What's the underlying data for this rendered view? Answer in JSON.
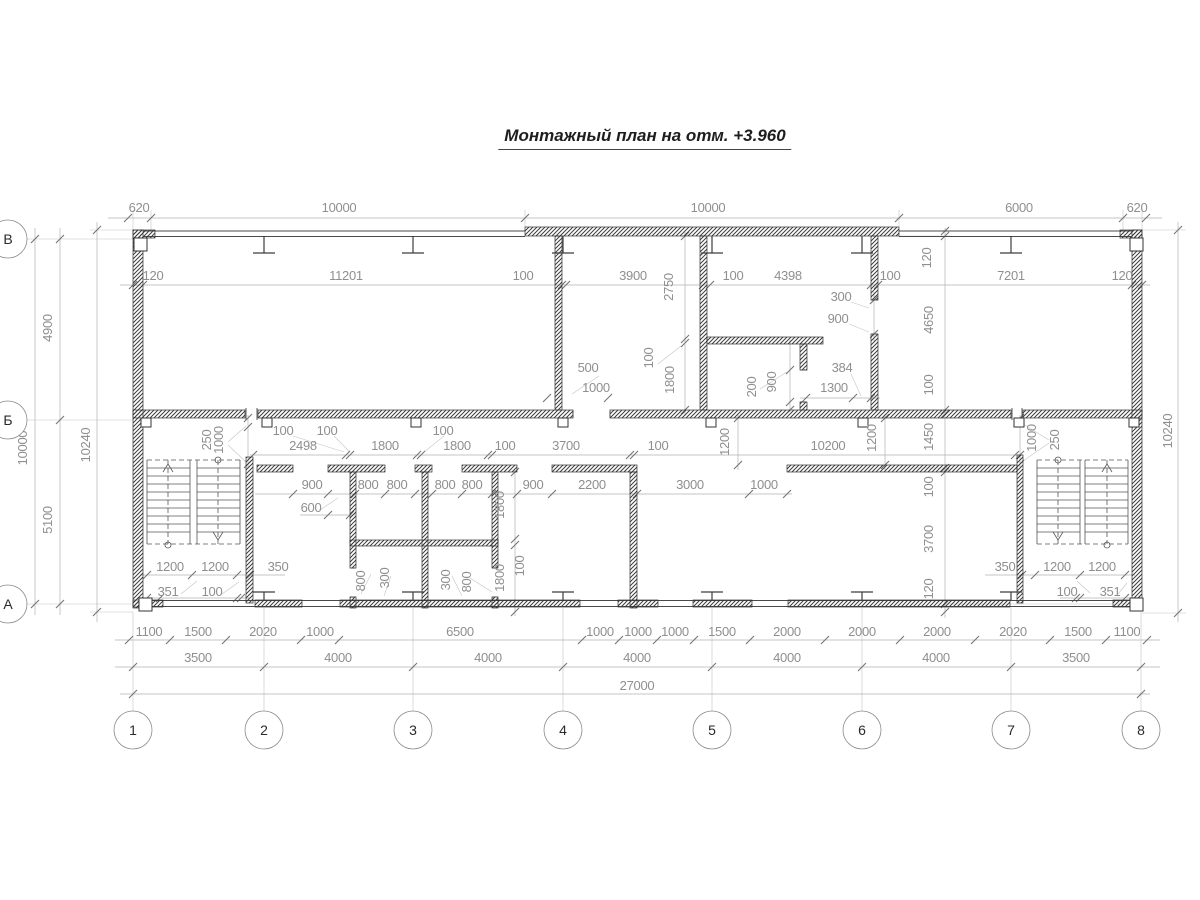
{
  "title": "Монтажный план на отм. +3.960",
  "colors": {
    "ink": "#3d3d3d",
    "dim_text": "#8f8f8f",
    "wall_hatch": "#3c3c3c",
    "background": "#ffffff"
  },
  "axes": {
    "bottom": [
      {
        "label": "1",
        "x": 133
      },
      {
        "label": "2",
        "x": 264
      },
      {
        "label": "3",
        "x": 413
      },
      {
        "label": "4",
        "x": 563
      },
      {
        "label": "5",
        "x": 712
      },
      {
        "label": "6",
        "x": 862
      },
      {
        "label": "7",
        "x": 1011
      },
      {
        "label": "8",
        "x": 1141
      }
    ],
    "left": [
      {
        "label": "В",
        "y": 239
      },
      {
        "label": "Б",
        "y": 420
      },
      {
        "label": "А",
        "y": 604
      }
    ]
  },
  "labels": [
    {
      "t": "620",
      "x": 139,
      "y": 212
    },
    {
      "t": "10000",
      "x": 339,
      "y": 212
    },
    {
      "t": "10000",
      "x": 708,
      "y": 212
    },
    {
      "t": "6000",
      "x": 1019,
      "y": 212
    },
    {
      "t": "620",
      "x": 1137,
      "y": 212
    },
    {
      "t": "120",
      "x": 153,
      "y": 280
    },
    {
      "t": "11201",
      "x": 346,
      "y": 280
    },
    {
      "t": "100",
      "x": 523,
      "y": 280
    },
    {
      "t": "3900",
      "x": 633,
      "y": 280
    },
    {
      "t": "100",
      "x": 733,
      "y": 280
    },
    {
      "t": "4398",
      "x": 788,
      "y": 280
    },
    {
      "t": "100",
      "x": 890,
      "y": 280
    },
    {
      "t": "7201",
      "x": 1011,
      "y": 280
    },
    {
      "t": "120",
      "x": 1122,
      "y": 280
    },
    {
      "t": "2750",
      "x": 673,
      "y": 287,
      "rot": true
    },
    {
      "t": "120",
      "x": 931,
      "y": 258,
      "rot": true
    },
    {
      "t": "4900",
      "x": 52,
      "y": 328,
      "rot": true
    },
    {
      "t": "10000",
      "x": 27,
      "y": 448,
      "rot": true
    },
    {
      "t": "10240",
      "x": 90,
      "y": 445,
      "rot": true
    },
    {
      "t": "5100",
      "x": 52,
      "y": 520,
      "rot": true
    },
    {
      "t": "10240",
      "x": 1172,
      "y": 431,
      "rot": true
    },
    {
      "t": "4650",
      "x": 933,
      "y": 320,
      "rot": true
    },
    {
      "t": "100",
      "x": 933,
      "y": 385,
      "rot": true
    },
    {
      "t": "1450",
      "x": 933,
      "y": 437,
      "rot": true
    },
    {
      "t": "100",
      "x": 933,
      "y": 487,
      "rot": true
    },
    {
      "t": "3700",
      "x": 933,
      "y": 539,
      "rot": true
    },
    {
      "t": "120",
      "x": 933,
      "y": 589,
      "rot": true
    },
    {
      "t": "300",
      "x": 841,
      "y": 301
    },
    {
      "t": "900",
      "x": 838,
      "y": 323
    },
    {
      "t": "500",
      "x": 588,
      "y": 372
    },
    {
      "t": "1000",
      "x": 596,
      "y": 392
    },
    {
      "t": "100",
      "x": 653,
      "y": 358,
      "rot": true
    },
    {
      "t": "1800",
      "x": 674,
      "y": 380,
      "rot": true
    },
    {
      "t": "200",
      "x": 756,
      "y": 387,
      "rot": true
    },
    {
      "t": "900",
      "x": 776,
      "y": 382,
      "rot": true
    },
    {
      "t": "384",
      "x": 842,
      "y": 372
    },
    {
      "t": "1300",
      "x": 834,
      "y": 392
    },
    {
      "t": "2498",
      "x": 303,
      "y": 450
    },
    {
      "t": "1800",
      "x": 385,
      "y": 450
    },
    {
      "t": "1800",
      "x": 457,
      "y": 450
    },
    {
      "t": "100",
      "x": 505,
      "y": 450
    },
    {
      "t": "3700",
      "x": 566,
      "y": 450
    },
    {
      "t": "100",
      "x": 658,
      "y": 450
    },
    {
      "t": "10200",
      "x": 828,
      "y": 450
    },
    {
      "t": "100",
      "x": 283,
      "y": 435
    },
    {
      "t": "100",
      "x": 327,
      "y": 435
    },
    {
      "t": "100",
      "x": 443,
      "y": 435
    },
    {
      "t": "1200",
      "x": 729,
      "y": 442,
      "rot": true
    },
    {
      "t": "1200",
      "x": 876,
      "y": 438,
      "rot": true
    },
    {
      "t": "250",
      "x": 211,
      "y": 440,
      "rot": true
    },
    {
      "t": "1000",
      "x": 223,
      "y": 440,
      "rot": true
    },
    {
      "t": "1000",
      "x": 1036,
      "y": 438,
      "rot": true
    },
    {
      "t": "250",
      "x": 1059,
      "y": 440,
      "rot": true
    },
    {
      "t": "900",
      "x": 312,
      "y": 489
    },
    {
      "t": "800",
      "x": 368,
      "y": 489
    },
    {
      "t": "800",
      "x": 397,
      "y": 489
    },
    {
      "t": "800",
      "x": 445,
      "y": 489
    },
    {
      "t": "800",
      "x": 472,
      "y": 489
    },
    {
      "t": "900",
      "x": 533,
      "y": 489
    },
    {
      "t": "2200",
      "x": 592,
      "y": 489
    },
    {
      "t": "3000",
      "x": 690,
      "y": 489
    },
    {
      "t": "1000",
      "x": 764,
      "y": 489
    },
    {
      "t": "600",
      "x": 311,
      "y": 512
    },
    {
      "t": "1800",
      "x": 504,
      "y": 505,
      "rot": true
    },
    {
      "t": "100",
      "x": 524,
      "y": 566,
      "rot": true
    },
    {
      "t": "1800",
      "x": 504,
      "y": 578,
      "rot": true
    },
    {
      "t": "800",
      "x": 365,
      "y": 581,
      "rot": true
    },
    {
      "t": "300",
      "x": 389,
      "y": 578,
      "rot": true
    },
    {
      "t": "300",
      "x": 450,
      "y": 580,
      "rot": true
    },
    {
      "t": "800",
      "x": 471,
      "y": 582,
      "rot": true
    },
    {
      "t": "1200",
      "x": 170,
      "y": 571
    },
    {
      "t": "1200",
      "x": 215,
      "y": 571
    },
    {
      "t": "350",
      "x": 278,
      "y": 571
    },
    {
      "t": "351",
      "x": 168,
      "y": 596
    },
    {
      "t": "100",
      "x": 212,
      "y": 596
    },
    {
      "t": "350",
      "x": 1005,
      "y": 571
    },
    {
      "t": "1200",
      "x": 1057,
      "y": 571
    },
    {
      "t": "1200",
      "x": 1102,
      "y": 571
    },
    {
      "t": "100",
      "x": 1067,
      "y": 596
    },
    {
      "t": "351",
      "x": 1110,
      "y": 596
    },
    {
      "t": "1100",
      "x": 149,
      "y": 636
    },
    {
      "t": "1500",
      "x": 198,
      "y": 636
    },
    {
      "t": "2020",
      "x": 263,
      "y": 636
    },
    {
      "t": "1000",
      "x": 320,
      "y": 636
    },
    {
      "t": "6500",
      "x": 460,
      "y": 636
    },
    {
      "t": "1000",
      "x": 600,
      "y": 636
    },
    {
      "t": "1000",
      "x": 638,
      "y": 636
    },
    {
      "t": "1000",
      "x": 675,
      "y": 636
    },
    {
      "t": "1500",
      "x": 722,
      "y": 636
    },
    {
      "t": "2000",
      "x": 787,
      "y": 636
    },
    {
      "t": "2000",
      "x": 862,
      "y": 636
    },
    {
      "t": "2000",
      "x": 937,
      "y": 636
    },
    {
      "t": "2020",
      "x": 1013,
      "y": 636
    },
    {
      "t": "1500",
      "x": 1078,
      "y": 636
    },
    {
      "t": "1100",
      "x": 1127,
      "y": 636
    },
    {
      "t": "3500",
      "x": 198,
      "y": 662
    },
    {
      "t": "4000",
      "x": 338,
      "y": 662
    },
    {
      "t": "4000",
      "x": 488,
      "y": 662
    },
    {
      "t": "4000",
      "x": 637,
      "y": 662
    },
    {
      "t": "4000",
      "x": 787,
      "y": 662
    },
    {
      "t": "4000",
      "x": 936,
      "y": 662
    },
    {
      "t": "3500",
      "x": 1076,
      "y": 662
    },
    {
      "t": "27000",
      "x": 637,
      "y": 690
    }
  ]
}
